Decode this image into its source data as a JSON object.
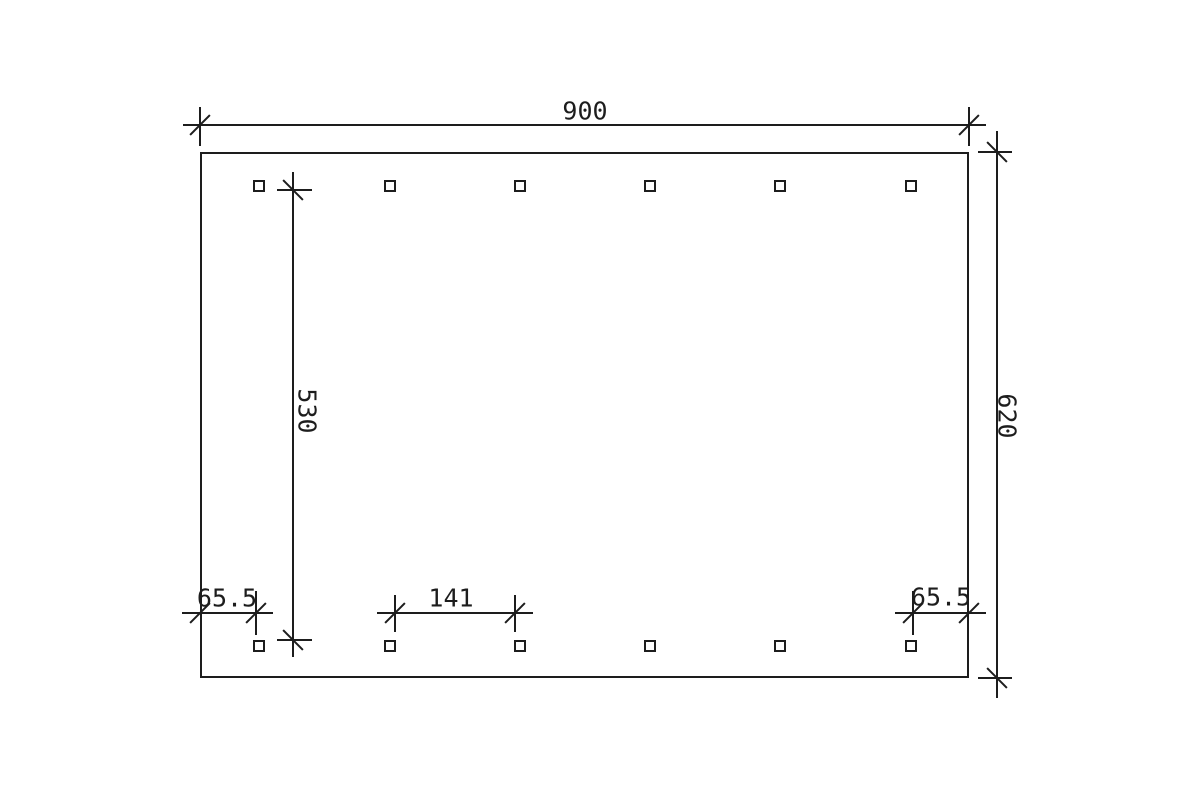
{
  "drawing": {
    "type": "technical-foundation-plan",
    "background": "#ffffff",
    "line_color": "#1d1d1d",
    "dimensions": {
      "top_width": "900",
      "right_height": "620",
      "left_post_span": "530",
      "bottom_left_offset": "65.5",
      "bottom_post_spacing": "141",
      "bottom_right_offset": "65.5"
    },
    "posts": {
      "columns_x": [
        259,
        390,
        520,
        650,
        780,
        911
      ],
      "rows_y": [
        186,
        646
      ],
      "size_px": 12,
      "count": 12
    }
  }
}
